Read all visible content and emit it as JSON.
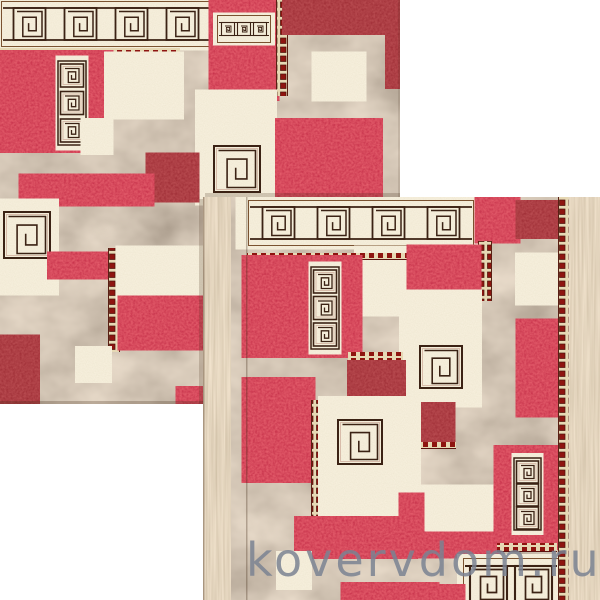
{
  "photo": {
    "description": "Two overlapping square carpets with red, dark-red and cream patchwork blocks and Greek key spiral ornaments on a mottled taupe background"
  },
  "watermark": {
    "text": "kovervdom.ru"
  },
  "colors": {
    "background": "#ffffff",
    "red": "#b01423",
    "dark_red": "#6e0b12",
    "cream": "#ece0c2",
    "taupe": "#a6927a",
    "outline_brown": "#3b2214",
    "ornament_red": "#8e1410",
    "fringe_beige": "#d8c6a3",
    "watermark_gray": "rgba(122,131,146,0.85)"
  }
}
